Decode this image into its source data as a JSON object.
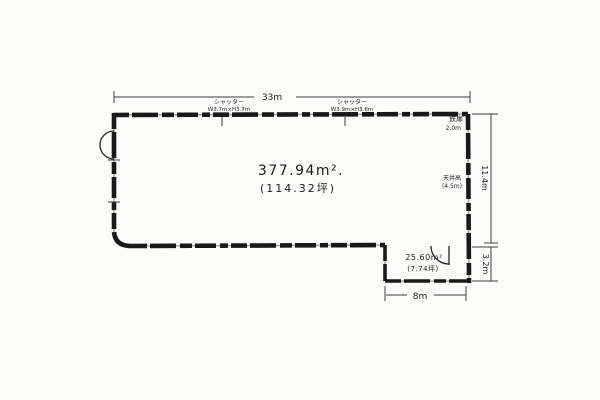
{
  "drawing": {
    "type": "floor-plan-sketch",
    "paper_color": "#fcfcfb",
    "ink_color": "#191919",
    "top_dimension": "33m",
    "shutter_1": {
      "name": "シャッター",
      "size": "W3.7m×H3.7m"
    },
    "shutter_2": {
      "name": "シャッター",
      "size": "W3.9m×H3.6m"
    },
    "steel_door": {
      "name": "鉄扉",
      "size": "2.0m"
    },
    "main_room": {
      "area_sqm": "377.94m².",
      "area_tsubo": "(114.32坪)"
    },
    "ceiling": {
      "name": "天井高",
      "size": "(4.5m)"
    },
    "right_dimension_main": "11.4m",
    "right_dimension_annex": "3.2m",
    "annex": {
      "area_sqm": "25.60m²",
      "area_tsubo": "(7.74坪)"
    },
    "bottom_dimension": "8m"
  }
}
